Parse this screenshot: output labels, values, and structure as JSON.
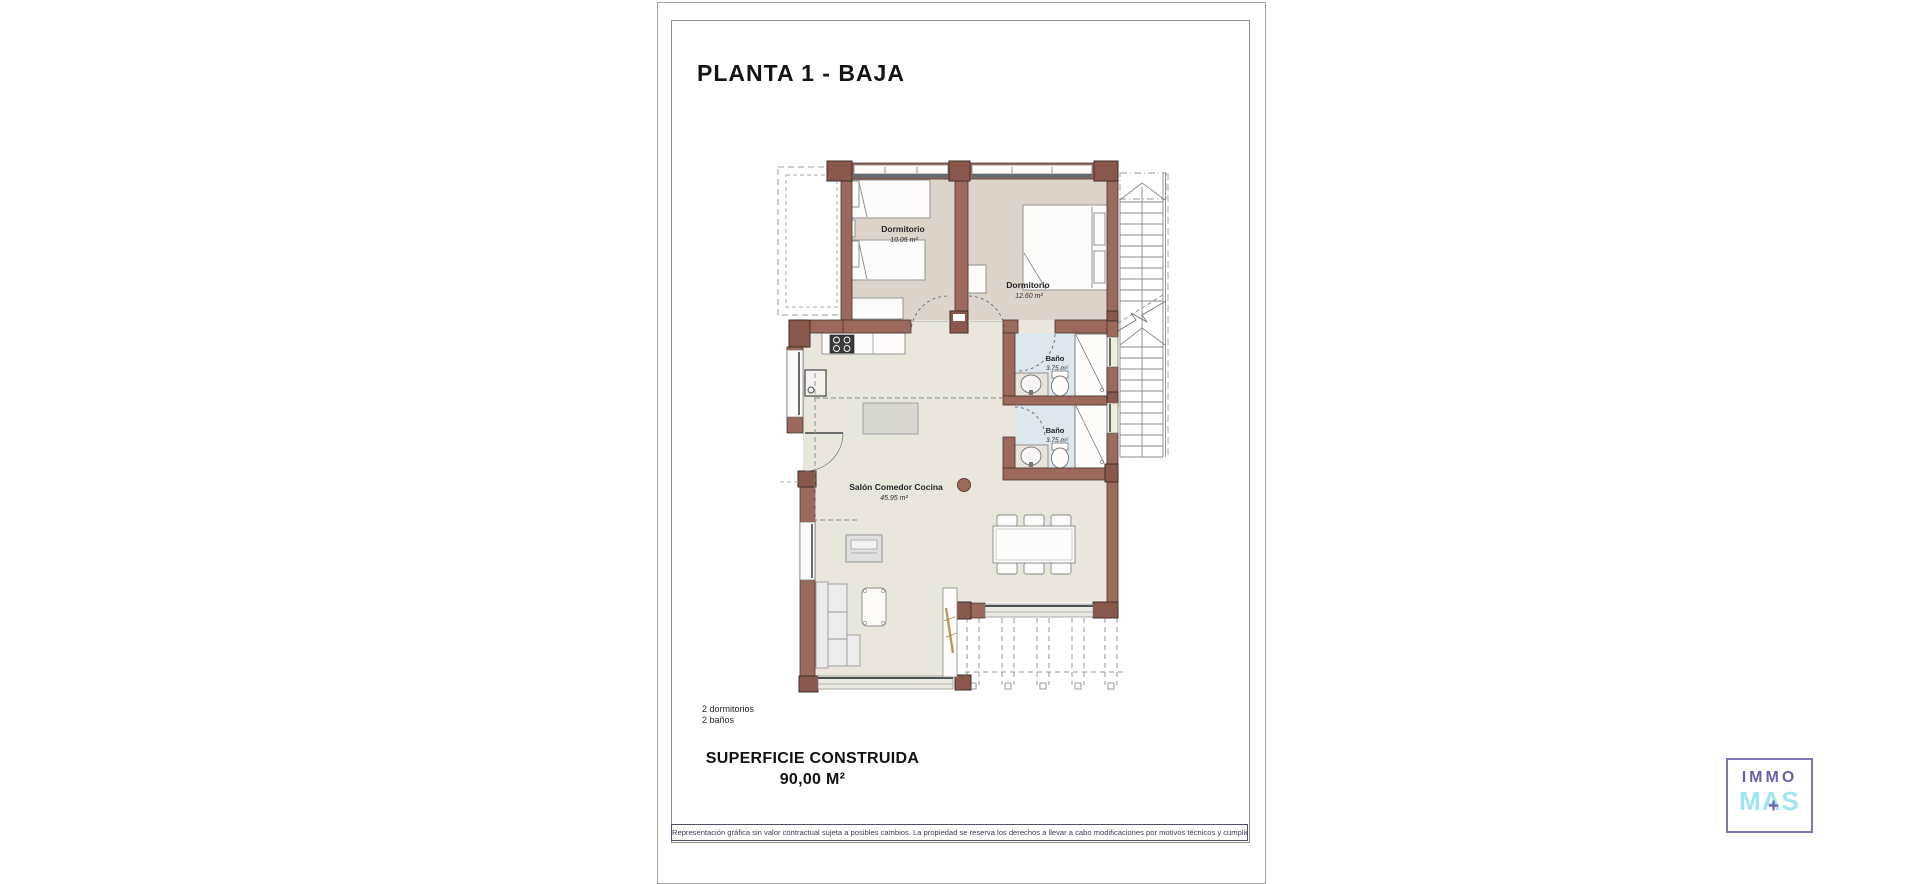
{
  "page": {
    "title": "PLANTA 1 - BAJA"
  },
  "plan": {
    "rooms": [
      {
        "id": "dormitorio-1",
        "name": "Dormitorio",
        "area": "10.05 m²"
      },
      {
        "id": "dormitorio-2",
        "name": "Dormitorio",
        "area": "12.60 m²"
      },
      {
        "id": "bano-1",
        "name": "Baño",
        "area": "3.75 m²"
      },
      {
        "id": "bano-2",
        "name": "Baño",
        "area": "3.75 m²"
      },
      {
        "id": "salon",
        "name": "Salón Comedor Cocina",
        "area": "45.95 m²"
      }
    ]
  },
  "summary": {
    "line1": "2 dormitorios",
    "line2": "2 baños"
  },
  "surface": {
    "label": "SUPERFICIE CONSTRUIDA",
    "value": "90,00 M²"
  },
  "disclaimer": "Representación gráfica sin valor contractual sujeta a posibles cambios. La propiedad se reserva los derechos a llevar a cabo modificaciones por motivos técnicos y cumpliendo la normativa vigente.",
  "logo": {
    "line1": "IMMO",
    "line2_left": "MA",
    "line2_right": "S",
    "plus": "+"
  },
  "colors": {
    "wall": "#9c6a5c",
    "wall_post": "#8a574c",
    "bedroom_floor": "#dcd3c9",
    "living_floor": "#ebe6dc",
    "bath_floor": "#dce7ee",
    "logo_purple": "#6a5fa8",
    "logo_cyan": "#9fe6f2"
  }
}
